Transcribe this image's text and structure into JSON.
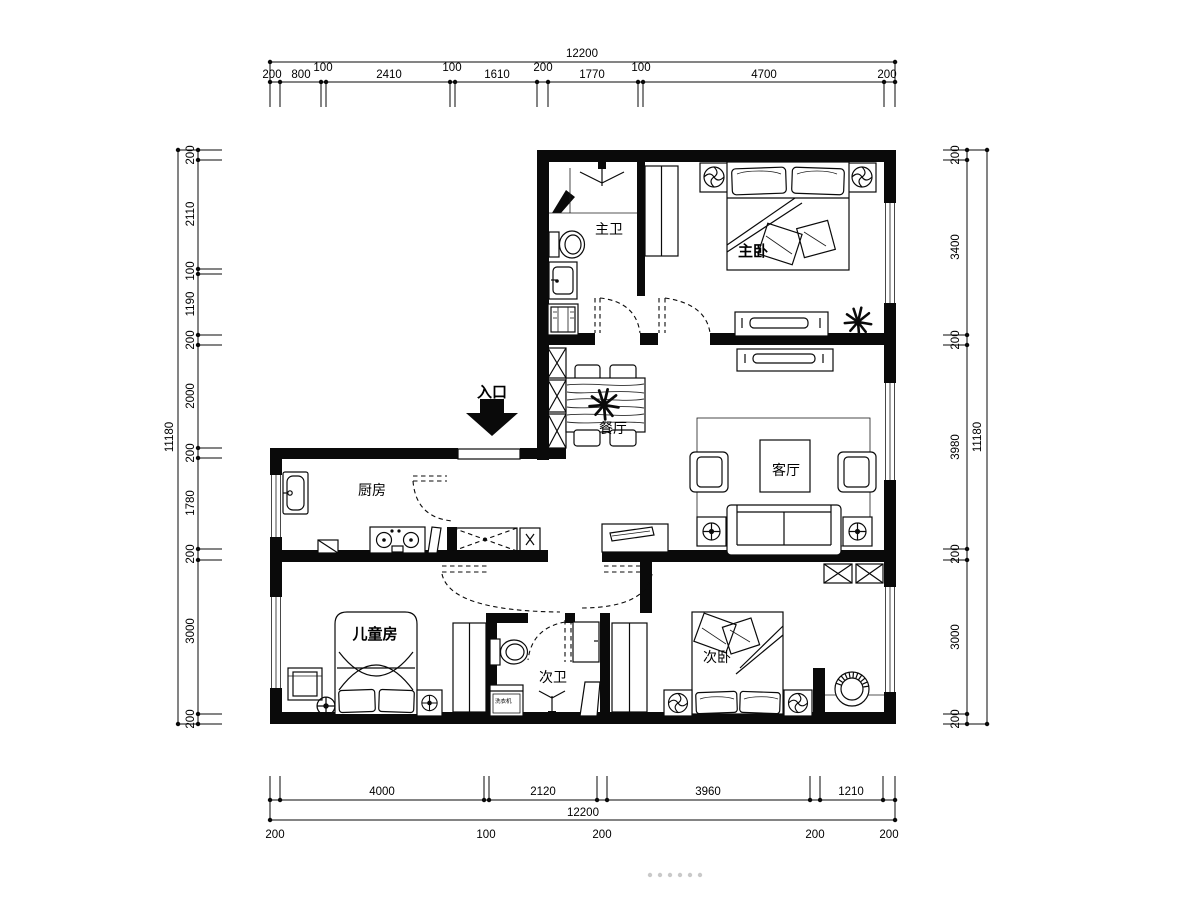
{
  "plan": {
    "rooms": {
      "entrance": "入口",
      "master_bath": "主卫",
      "master_bedroom": "主卧",
      "dining": "餐厅",
      "living": "客厅",
      "kitchen": "厨房",
      "kids_room": "儿童房",
      "second_bath": "次卫",
      "second_bedroom": "次卧",
      "washer": "洗衣机"
    },
    "dims": {
      "top": {
        "total": "12200",
        "s": [
          "200",
          "800",
          "100",
          "2410",
          "100",
          "1610",
          "200",
          "1770",
          "100",
          "4700",
          "200"
        ]
      },
      "bottom": {
        "total": "12200",
        "upper": [
          "4000",
          "2120",
          "3960",
          "1210"
        ],
        "lower": [
          "200",
          "100",
          "200",
          "200",
          "200"
        ]
      },
      "left": {
        "total": "11180",
        "s": [
          "200",
          "2110",
          "100",
          "1190",
          "200",
          "2000",
          "200",
          "1780",
          "200",
          "3000",
          "200"
        ]
      },
      "right": {
        "total": "11180",
        "s": [
          "200",
          "3400",
          "200",
          "3980",
          "200",
          "3000",
          "200"
        ]
      }
    }
  }
}
